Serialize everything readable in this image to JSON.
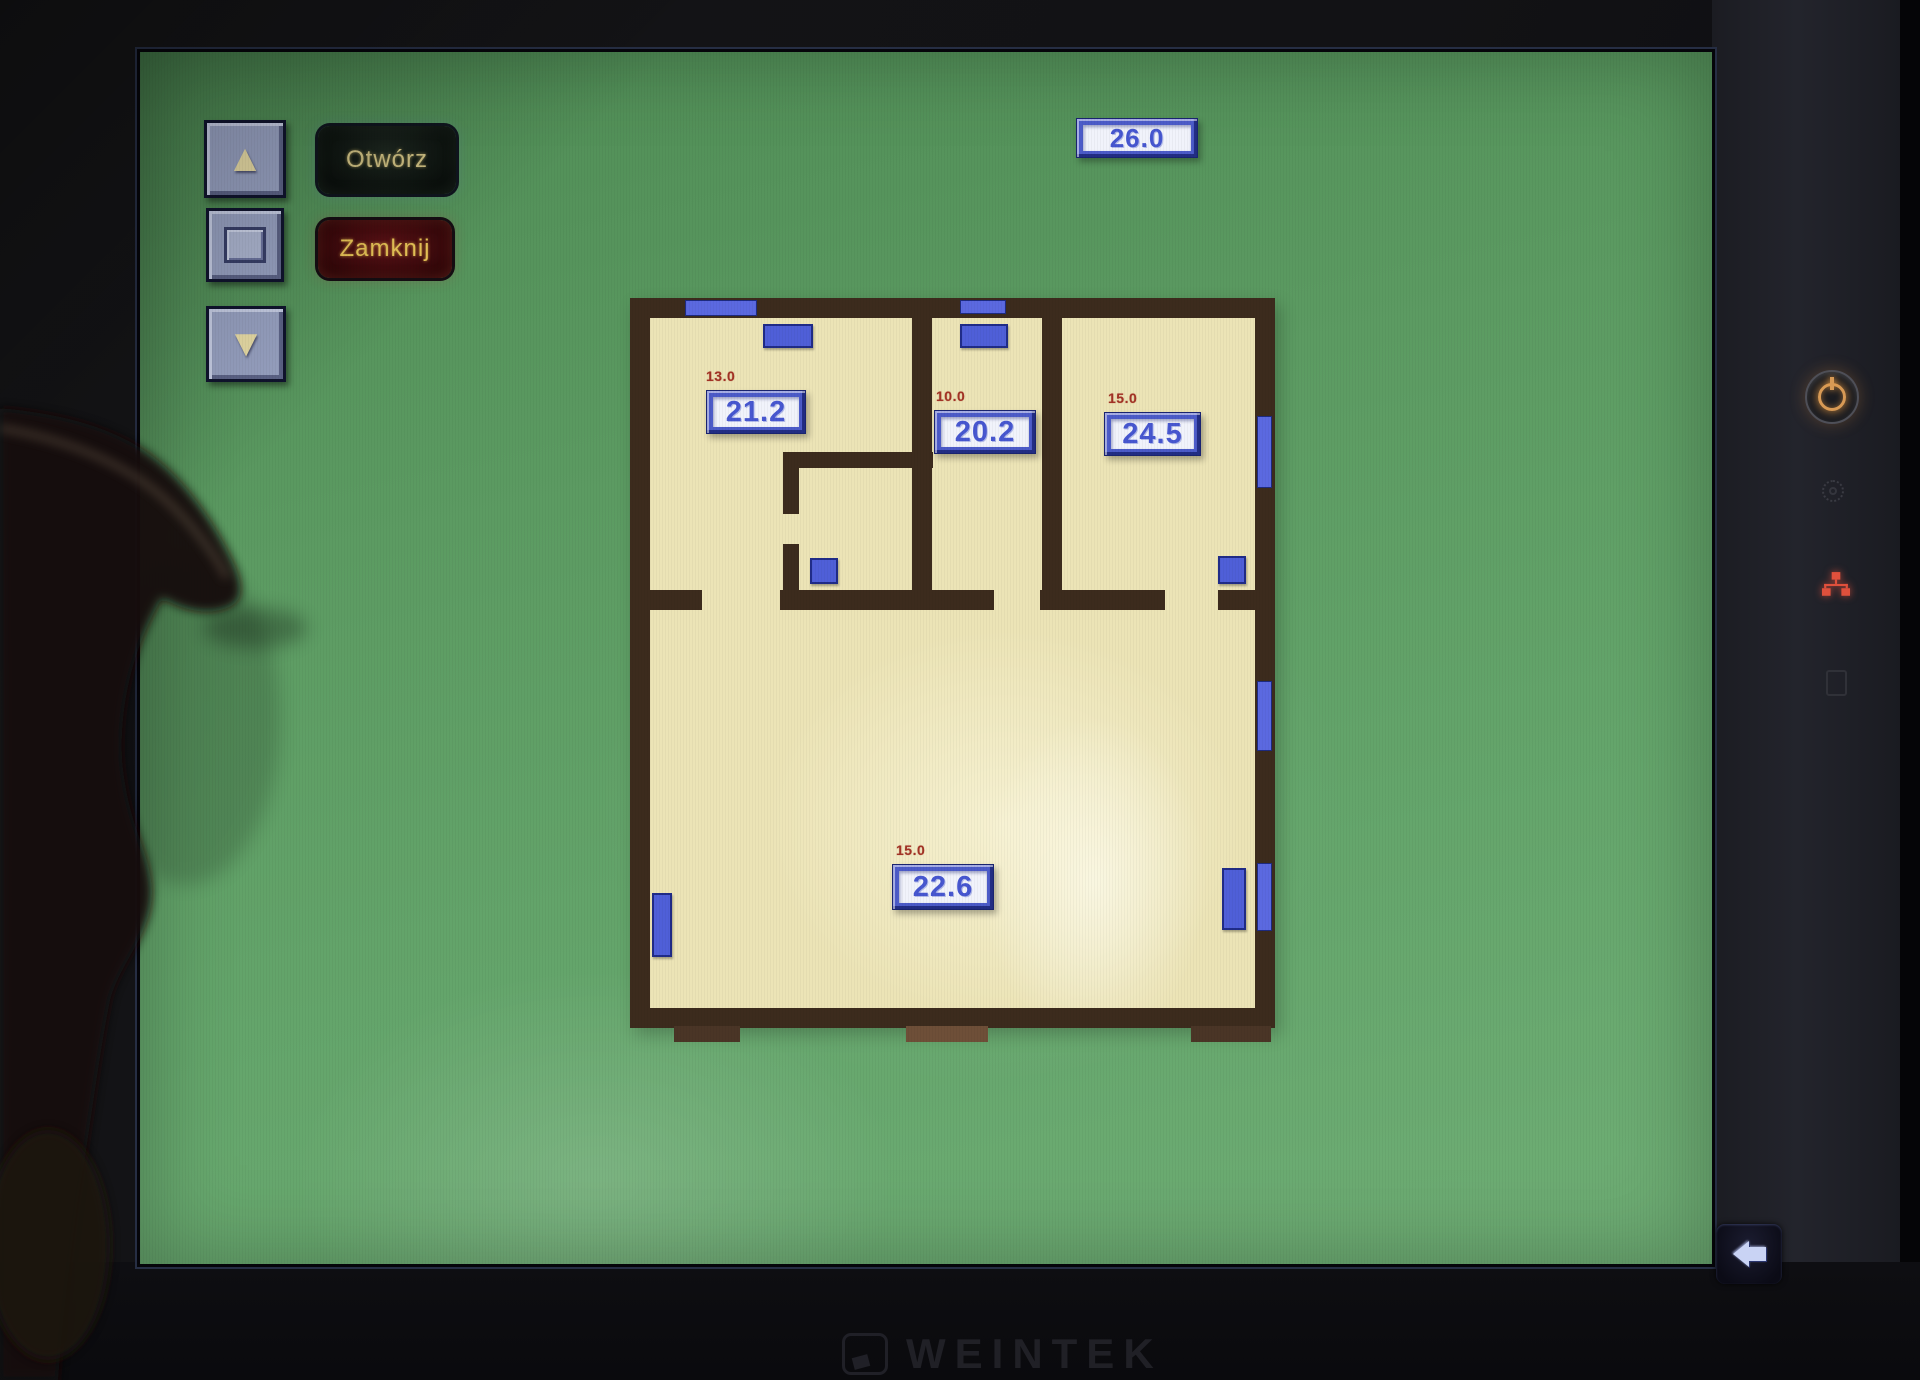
{
  "device": {
    "brand": "WEINTEK",
    "indicators": {
      "power": "power-button",
      "brightness": "brightness-indicator",
      "network": "ethernet-indicator",
      "sd": "sd-card-slot"
    }
  },
  "screen": {
    "shutters": {
      "up_icon": "▲",
      "down_icon": "▼",
      "stop_icon": "stop-square",
      "open_label": "Otwórz",
      "close_label": "Zamknij"
    },
    "outdoor": {
      "temperature": "26.0"
    },
    "sidebar": {
      "buttons": [
        "Parter",
        "Piętro",
        "Garaż",
        "ZTP",
        "ZDC",
        "Grzejniki",
        "Reg pog",
        "Rolety",
        "Ster pomp",
        "Info"
      ],
      "footer_label": "Wybierz"
    },
    "floorplan": {
      "rooms": [
        {
          "name": "room-top-left",
          "setpoint": "13.0",
          "temperature": "21.2"
        },
        {
          "name": "room-top-middle",
          "setpoint": "10.0",
          "temperature": "20.2"
        },
        {
          "name": "room-top-right",
          "setpoint": "15.0",
          "temperature": "24.5"
        },
        {
          "name": "room-main",
          "setpoint": "15.0",
          "temperature": "22.6"
        }
      ]
    },
    "back_icon": "arrow-left"
  },
  "colors": {
    "screen_green": "#5c9b62",
    "plan_floor": "#ece4b6",
    "wall_brown": "#3c2b1d",
    "window_blue": "#5b69e0",
    "display_frame_blue": "#4c5bc8",
    "display_text_blue": "#4757d0",
    "setpoint_red": "#a33325",
    "button_yellow": "#f2d95e",
    "open_text": "#cfc083",
    "close_bg": "#5c1116",
    "network_led_red": "#e0503c"
  }
}
